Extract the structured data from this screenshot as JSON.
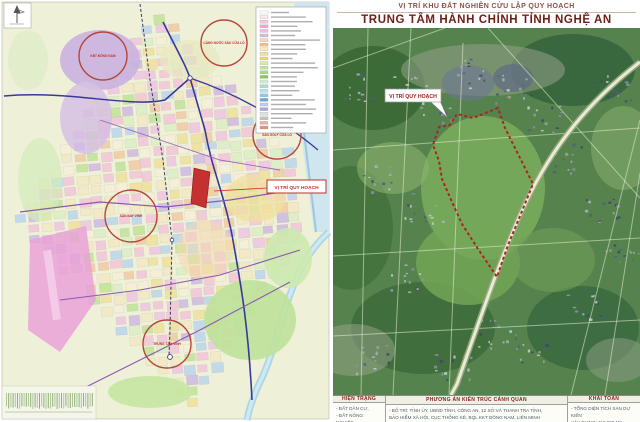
{
  "right_panel": {
    "title_small": "VỊ TRÍ KHU ĐẤT NGHIÊN CỨU LẬP QUY HOẠCH",
    "title_main": "TRUNG TÂM HÀNH CHÍNH TỈNH NGHỆ AN",
    "callout_label": "VỊ TRÍ QUY HOẠCH",
    "boundary_color": "#a8281c",
    "table": {
      "columns": [
        {
          "header": "HIỆN TRẠNG",
          "lines": [
            "- ĐẤT DÂN CƯ,",
            "- ĐẤT NÔNG NGHIỆP,"
          ]
        },
        {
          "header": "PHƯƠNG ÁN KIẾN TRÚC CẢNH QUAN",
          "lines": [
            "- BỐ TRÍ: TỈNH ỦY, UBND TỈNH, CÔNG AN, 12 SỞ VÀ THANH TRA TỈNH,",
            "BẢO HIỂM XÃ HỘI, CỤC THỐNG KÊ, BQL KKT ĐÔNG NAM, LIÊN MINH"
          ]
        },
        {
          "header": "KHÁI TOÁN",
          "lines": [
            "- TỔNG DIỆN TÍCH SÀN DỰ KIẾN",
            "XÂY DỰNG: 110.000 M2"
          ]
        }
      ]
    }
  },
  "left_panel": {
    "location_label": "VỊ TRÍ QUY HOẠCH",
    "highlight_color": "#c03028",
    "circle_labels": [
      "KĐT ĐÔNG NAM",
      "CẢNG NƯỚC SÂU CỬA LÒ",
      "SÂN GOLF CỬA LÒ",
      "SÂN BAY VINH",
      "TRUNG TÂM VINH"
    ],
    "legend_swatches": [
      "#ffffff",
      "#fce8ee",
      "#f7c8da",
      "#f3a8c8",
      "#eec2e2",
      "#d8b8e8",
      "#f6d8b8",
      "#f0c088",
      "#f6ebc0",
      "#f0e098",
      "#e8d878",
      "#d8e8b0",
      "#c2e29a",
      "#a8d87a",
      "#8cc85c",
      "#d0ecd8",
      "#a8dcc8",
      "#b8dff0",
      "#90c8e8",
      "#68a8d8",
      "#c8c8e8",
      "#a8a8d8",
      "#e0e0e0",
      "#c0c0c0",
      "#f0b0a0",
      "#e89080"
    ]
  }
}
